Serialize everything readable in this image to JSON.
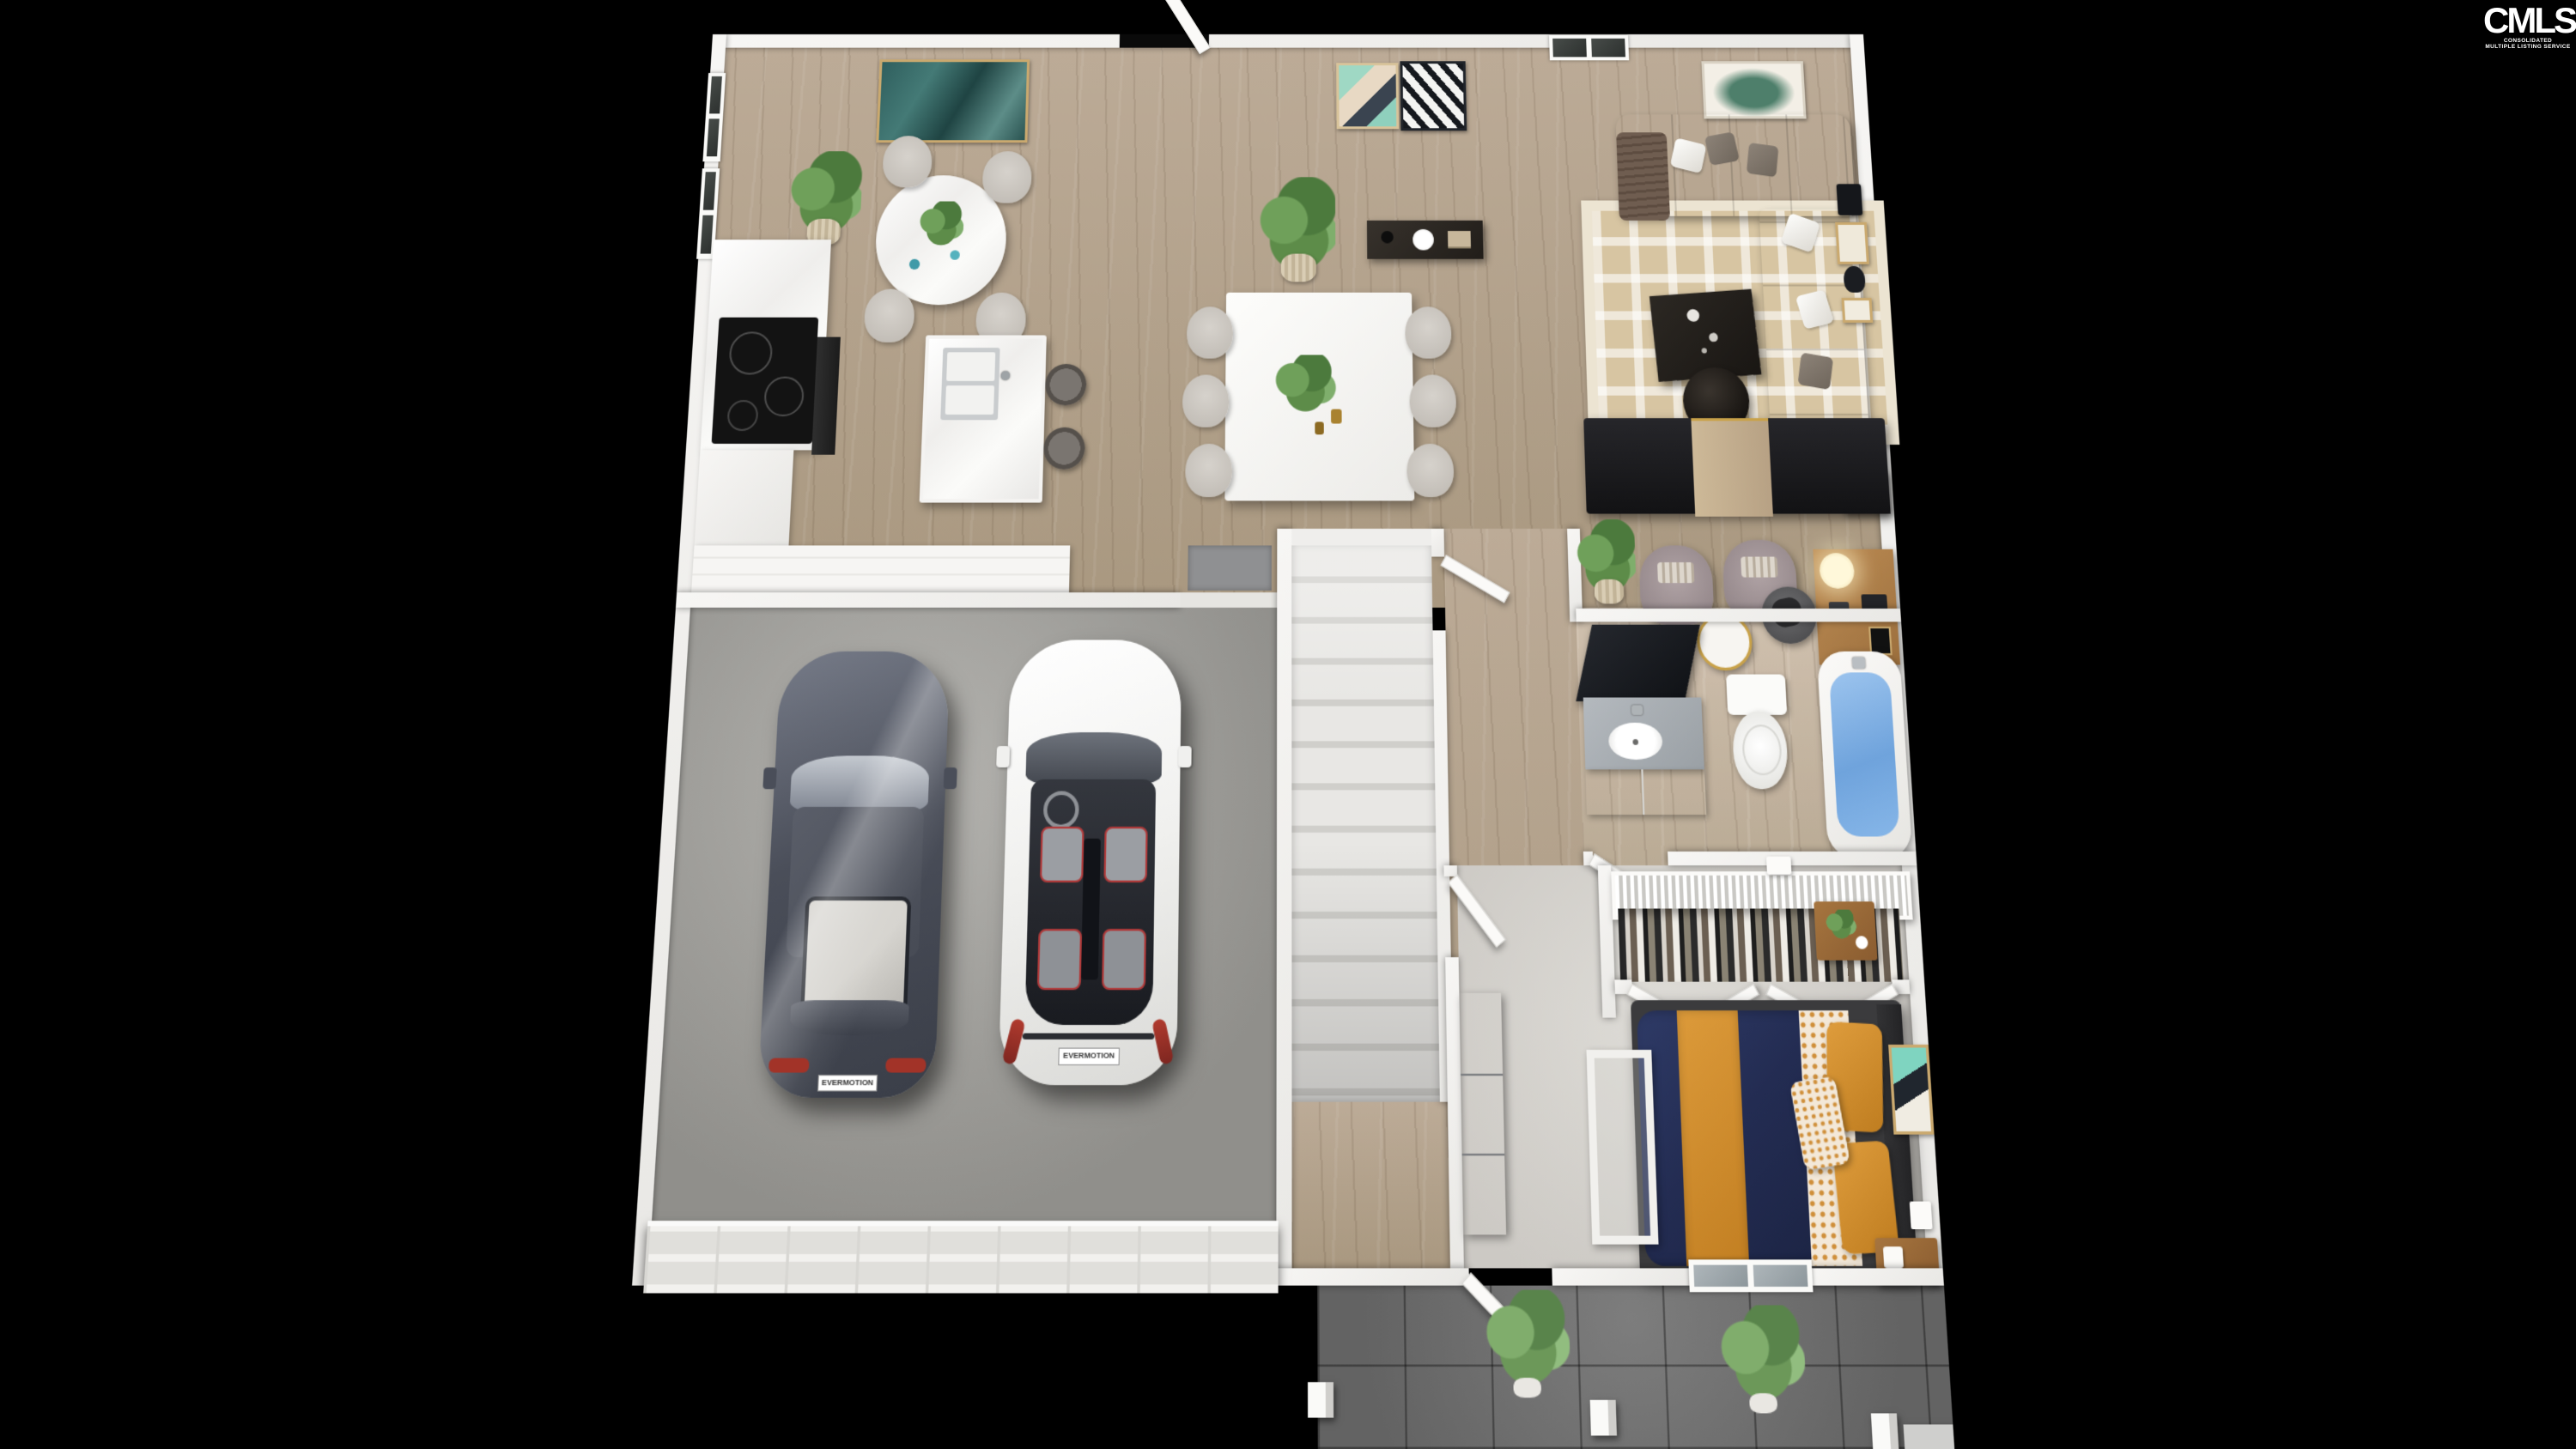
{
  "watermark": {
    "brand": "CMLS",
    "subtext_line1": "CONSOLIDATED",
    "subtext_line2": "MULTIPLE LISTING SERVICE"
  },
  "scene": {
    "description": "3D rendered dollhouse top-down view of a first floor plan on a black background",
    "view": "top-down 3D render",
    "background_color": "#000000"
  },
  "palette": {
    "wall_white": "#f2f1ee",
    "wood_floor": "#b3a28e",
    "bedroom_carpet": "#d8d6d1",
    "garage_concrete": "#a3a29e",
    "porch_tile": "#707070",
    "bedding_navy": "#273055",
    "bedding_orange": "#d08a2e",
    "tub_water": "#7fb2e6",
    "sofa_taupe": "#8a8076",
    "rug_beige": "#d7c5a2",
    "accent_teal": "#2f5f5e",
    "accent_gold": "#c9a24a"
  },
  "rooms": [
    {
      "name": "Kitchen / Breakfast Nook",
      "furniture": [
        "round marble dining table",
        "4 upholstered chairs",
        "potted plant",
        "teal abstract wall art",
        "cooktop counter",
        "oven",
        "pantry cabinets",
        "kitchen island with double sink",
        "2 bar stools",
        "floor mat"
      ]
    },
    {
      "name": "Dining / Entry",
      "furniture": [
        "open front door",
        "rectangular dining table",
        "6 upholstered chairs",
        "plant centerpiece",
        "dark console table with white vase",
        "potted palm",
        "two framed art prints",
        "window"
      ]
    },
    {
      "name": "Living Room",
      "furniture": [
        "L-shaped taupe sectional sofa",
        "throw pillows",
        "throw blanket",
        "geometric beige area rug",
        "dark coffee table",
        "round side table",
        "media wall with wood accent",
        "small side cabinet",
        "gallery wall frames",
        "leaf art print"
      ]
    },
    {
      "name": "Stair Hall",
      "furniture": [
        "carpeted staircase",
        "white interior doors"
      ]
    },
    {
      "name": "Sitting Area",
      "furniture": [
        "2 mauve accent armchairs",
        "round gold side table",
        "wood desk",
        "desk lamp",
        "desk chair",
        "potted plant"
      ]
    },
    {
      "name": "Bathroom",
      "furniture": [
        "vanity with dark mirror",
        "gray marble counter with sink",
        "toilet",
        "bathtub filled with water"
      ]
    },
    {
      "name": "Bedroom",
      "furniture": [
        "bed with navy duvet and orange stripe",
        "patterned sheets",
        "2 orange pillows",
        "dark headboard",
        "foot bench",
        "2 wood nightstands",
        "small plant",
        "gray dresser",
        "wall art",
        "wall lights",
        "window"
      ]
    },
    {
      "name": "Closet",
      "furniture": [
        "white wire shelf",
        "hanging clothes",
        "bifold doors"
      ]
    },
    {
      "name": "Garage",
      "furniture": [
        "graphite sedan",
        "white hatchback",
        "paneled garage door",
        "door mat"
      ]
    },
    {
      "name": "Front Porch",
      "furniture": [
        "dark tile paving",
        "2 potted shrubs",
        "3 white posts",
        "entry step"
      ]
    }
  ],
  "vehicles": [
    {
      "name": "graphite sedan",
      "body_color": "#4a4e59",
      "license_plate": "EVERMOTION"
    },
    {
      "name": "white hatchback",
      "body_color": "#f4f4f2",
      "license_plate": "EVERMOTION"
    }
  ]
}
